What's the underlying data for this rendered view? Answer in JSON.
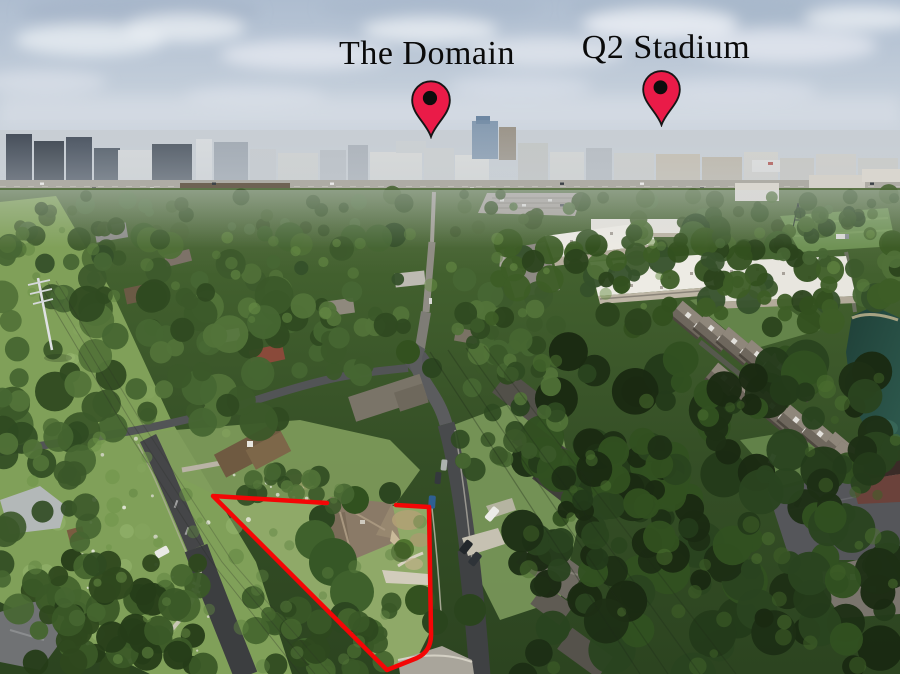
{
  "annotations": {
    "pins": [
      {
        "id": "the-domain",
        "label": "The Domain",
        "pin_color": "#ea1b48",
        "dot_color": "#0d0d0d"
      },
      {
        "id": "q2-stadium",
        "label": "Q2 Stadium",
        "pin_color": "#ea1b48",
        "dot_color": "#0d0d0d"
      }
    ],
    "property_outline": {
      "color": "#f40606"
    },
    "label_text_color": "#0a0a0a"
  }
}
